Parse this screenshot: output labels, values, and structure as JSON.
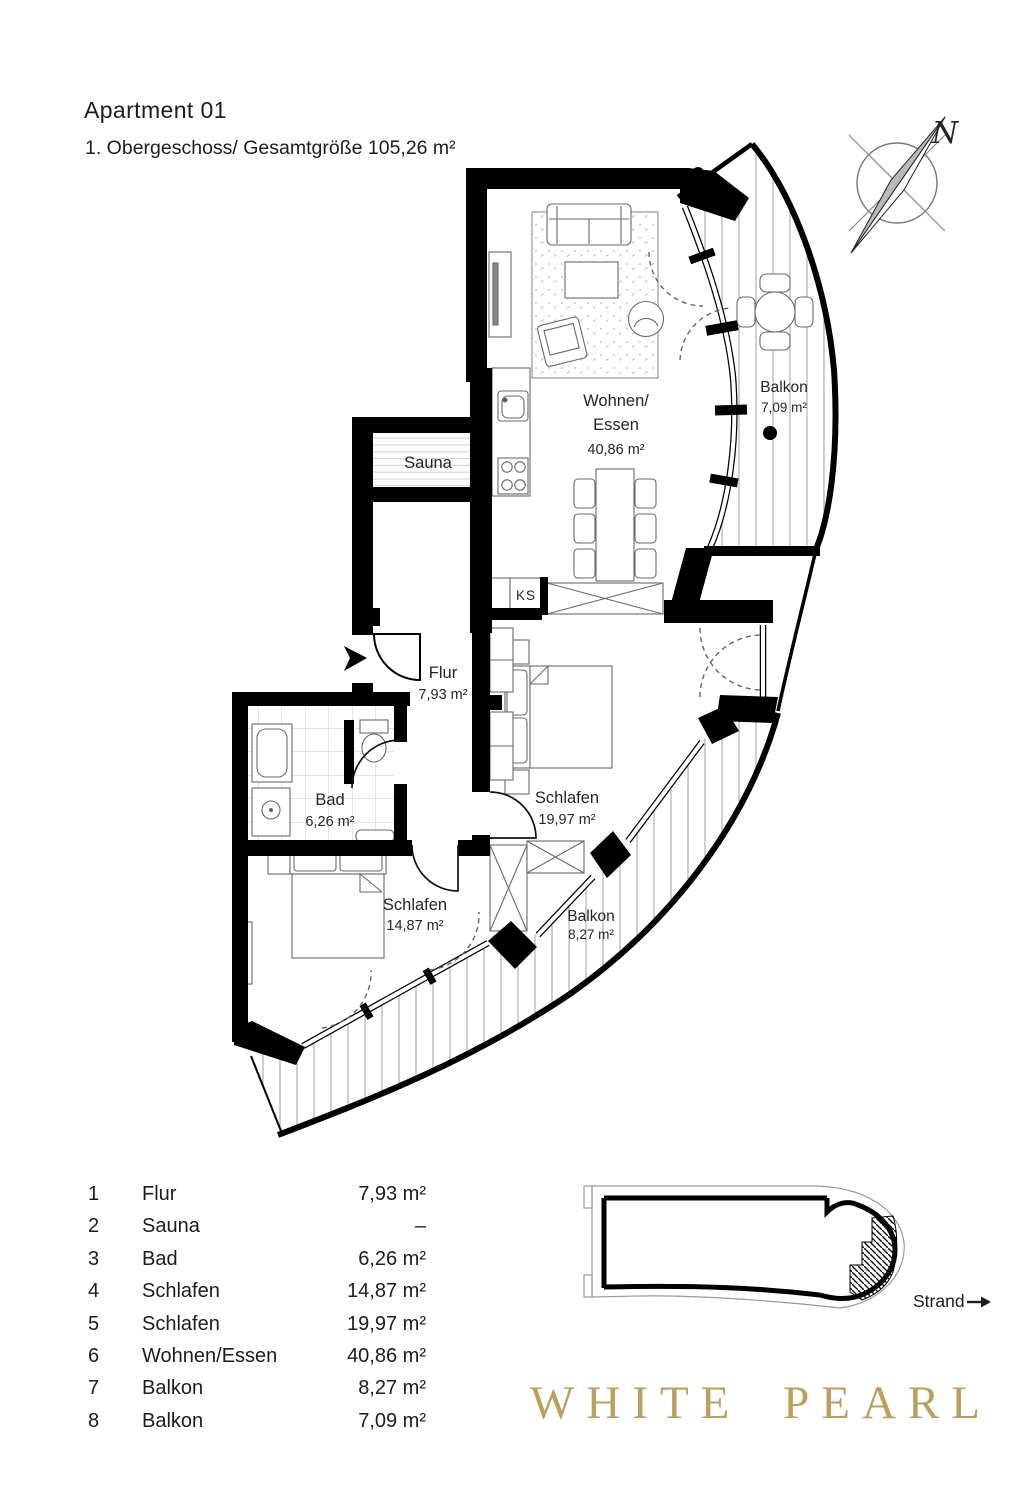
{
  "header": {
    "title": "Apartment 01",
    "subtitle": "1. Obergeschoss/ Gesamtgröße 105,26 m²"
  },
  "compass": {
    "north_label": "N"
  },
  "plan": {
    "rooms": {
      "wohnen_essen": {
        "line1": "Wohnen/",
        "line2": "Essen",
        "area": "40,86 m²"
      },
      "sauna": {
        "name": "Sauna"
      },
      "balkon_oben": {
        "name": "Balkon",
        "area": "7,09 m²"
      },
      "flur": {
        "name": "Flur",
        "area": "7,93 m²"
      },
      "bad": {
        "name": "Bad",
        "area": "6,26 m²"
      },
      "schlafen_gross": {
        "name": "Schlafen",
        "area": "19,97 m²"
      },
      "schlafen_klein": {
        "name": "Schlafen",
        "area": "14,87 m²"
      },
      "balkon_unten": {
        "name": "Balkon",
        "area": "8,27 m²"
      },
      "kuehlschrank": {
        "label": "KS"
      }
    }
  },
  "legend": {
    "rows": [
      {
        "no": "1",
        "name": "Flur",
        "area": "7,93 m²"
      },
      {
        "no": "2",
        "name": "Sauna",
        "area": "–"
      },
      {
        "no": "3",
        "name": "Bad",
        "area": "6,26 m²"
      },
      {
        "no": "4",
        "name": "Schlafen",
        "area": "14,87 m²"
      },
      {
        "no": "5",
        "name": "Schlafen",
        "area": "19,97 m²"
      },
      {
        "no": "6",
        "name": "Wohnen/Essen",
        "area": "40,86 m²"
      },
      {
        "no": "7",
        "name": "Balkon",
        "area": "8,27 m²"
      },
      {
        "no": "8",
        "name": "Balkon",
        "area": "7,09 m²"
      }
    ]
  },
  "key_plan": {
    "location_label": "Strand"
  },
  "brand": {
    "logo_text": "WHITE PEARL",
    "logo_color": "#b9a05e"
  }
}
